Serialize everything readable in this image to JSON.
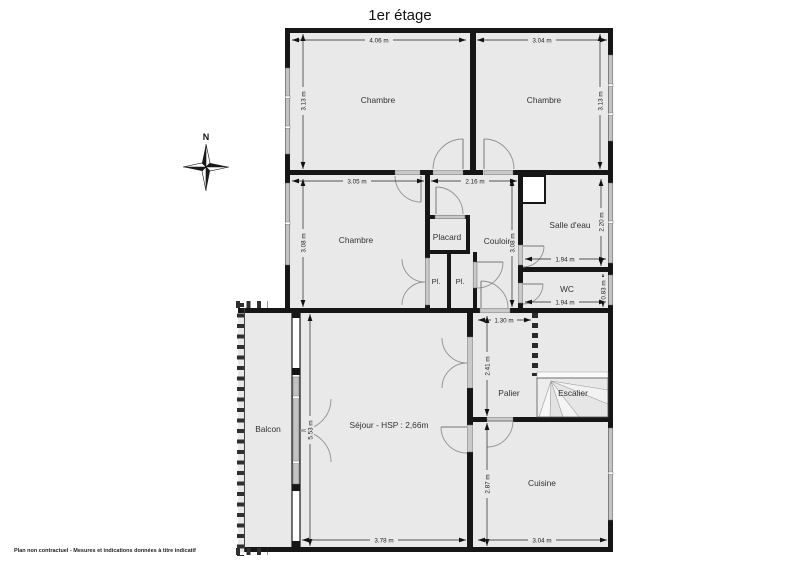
{
  "title": "1er étage",
  "compass": {
    "label": "N"
  },
  "floor_plan": {
    "rooms": [
      {
        "id": "chambre-1",
        "label": "Chambre"
      },
      {
        "id": "chambre-2",
        "label": "Chambre"
      },
      {
        "id": "chambre-3",
        "label": "Chambre"
      },
      {
        "id": "placard",
        "label": "Placard"
      },
      {
        "id": "couloir",
        "label": "Couloir"
      },
      {
        "id": "salle-deau",
        "label": "Salle d'eau"
      },
      {
        "id": "wc",
        "label": "WC"
      },
      {
        "id": "placard-small-1",
        "label": "Pl."
      },
      {
        "id": "placard-small-2",
        "label": "Pl."
      },
      {
        "id": "balcon",
        "label": "Balcon"
      },
      {
        "id": "sejour",
        "label": "Séjour - HSP : 2,66m"
      },
      {
        "id": "palier",
        "label": "Palier"
      },
      {
        "id": "escalier",
        "label": "Escalier"
      },
      {
        "id": "cuisine",
        "label": "Cuisine"
      }
    ],
    "dimensions": [
      {
        "room": "chambre-1",
        "edge": "width",
        "label": "4.06 m"
      },
      {
        "room": "chambre-2",
        "edge": "width",
        "label": "3.04 m"
      },
      {
        "room": "chambre-1",
        "edge": "depth",
        "label": "3.13 m"
      },
      {
        "room": "chambre-2",
        "edge": "depth",
        "label": "3.13 m"
      },
      {
        "room": "chambre-3",
        "edge": "width",
        "label": "3.05 m"
      },
      {
        "room": "couloir-haut",
        "edge": "width",
        "label": "2.16 m"
      },
      {
        "room": "chambre-3",
        "edge": "depth",
        "label": "3.08 m"
      },
      {
        "room": "couloir",
        "edge": "depth",
        "label": "3.08 m"
      },
      {
        "room": "salle-deau",
        "edge": "depth",
        "label": "2.20 m"
      },
      {
        "room": "salle-deau",
        "edge": "width",
        "label": "1.94 m"
      },
      {
        "room": "wc",
        "edge": "depth",
        "label": "0.83 m"
      },
      {
        "room": "wc",
        "edge": "width",
        "label": "1.94 m"
      },
      {
        "room": "palier",
        "edge": "width",
        "label": "1.30 m"
      },
      {
        "room": "palier",
        "edge": "depth",
        "label": "2.41 m"
      },
      {
        "room": "sejour",
        "edge": "depth",
        "label": "5.53 m"
      },
      {
        "room": "sejour",
        "edge": "width",
        "label": "3.78 m"
      },
      {
        "room": "cuisine",
        "edge": "depth",
        "label": "2.87 m"
      },
      {
        "room": "cuisine",
        "edge": "width",
        "label": "3.04 m"
      }
    ]
  },
  "footer": {
    "disclaimer": "Plan non contractuel - Mesures et indications données à titre indicatif"
  },
  "colors": {
    "wall": "#161616",
    "floor": "#e9e9e9",
    "window": "#c3c3c3",
    "background": "#ffffff"
  }
}
